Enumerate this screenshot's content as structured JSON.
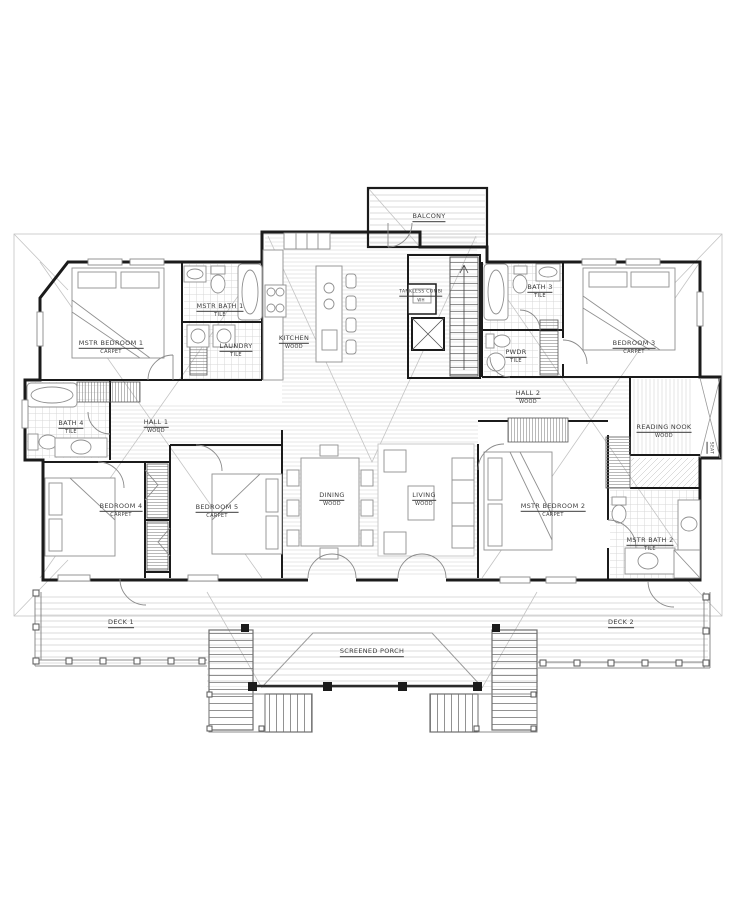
{
  "drawing": {
    "type": "residential floor plan",
    "colors": {
      "background": "#ffffff",
      "wall_ink": "#1b1b1b",
      "roof_line_gray": "#c4c4c4",
      "label_ink": "#3c3c3c"
    },
    "rooms": [
      {
        "id": "balcony",
        "name": "BALCONY",
        "material": ""
      },
      {
        "id": "mstr-bedroom-1",
        "name": "MSTR BEDROOM 1",
        "material": "CARPET"
      },
      {
        "id": "mstr-bath-1",
        "name": "MSTR BATH 1",
        "material": "TILE"
      },
      {
        "id": "laundry",
        "name": "LAUNDRY",
        "material": "TILE"
      },
      {
        "id": "kitchen",
        "name": "KITCHEN",
        "material": "WOOD"
      },
      {
        "id": "tankless",
        "name": "TANKLESS COMBI",
        "material": "WH"
      },
      {
        "id": "bath-3",
        "name": "BATH 3",
        "material": "TILE"
      },
      {
        "id": "pwdr",
        "name": "PWDR",
        "material": "TILE"
      },
      {
        "id": "bedroom-3",
        "name": "BEDROOM 3",
        "material": "CARPET"
      },
      {
        "id": "hall-2",
        "name": "HALL 2",
        "material": "WOOD"
      },
      {
        "id": "reading-nook",
        "name": "READING NOOK",
        "material": "WOOD"
      },
      {
        "id": "seat",
        "name": "SEAT",
        "material": ""
      },
      {
        "id": "bath-4",
        "name": "BATH 4",
        "material": "TILE"
      },
      {
        "id": "hall-1",
        "name": "HALL 1",
        "material": "WOOD"
      },
      {
        "id": "bedroom-4",
        "name": "BEDROOM 4",
        "material": "CARPET"
      },
      {
        "id": "bedroom-5",
        "name": "BEDROOM 5",
        "material": "CARPET"
      },
      {
        "id": "dining",
        "name": "DINING",
        "material": "WOOD"
      },
      {
        "id": "living",
        "name": "LIVING",
        "material": "WOOD"
      },
      {
        "id": "mstr-bedroom-2",
        "name": "MSTR BEDROOM 2",
        "material": "CARPET"
      },
      {
        "id": "mstr-bath-2",
        "name": "MSTR BATH 2",
        "material": "TILE"
      },
      {
        "id": "deck-1",
        "name": "DECK 1",
        "material": ""
      },
      {
        "id": "deck-2",
        "name": "DECK 2",
        "material": ""
      },
      {
        "id": "screened-porch",
        "name": "SCREENED PORCH",
        "material": ""
      }
    ]
  }
}
